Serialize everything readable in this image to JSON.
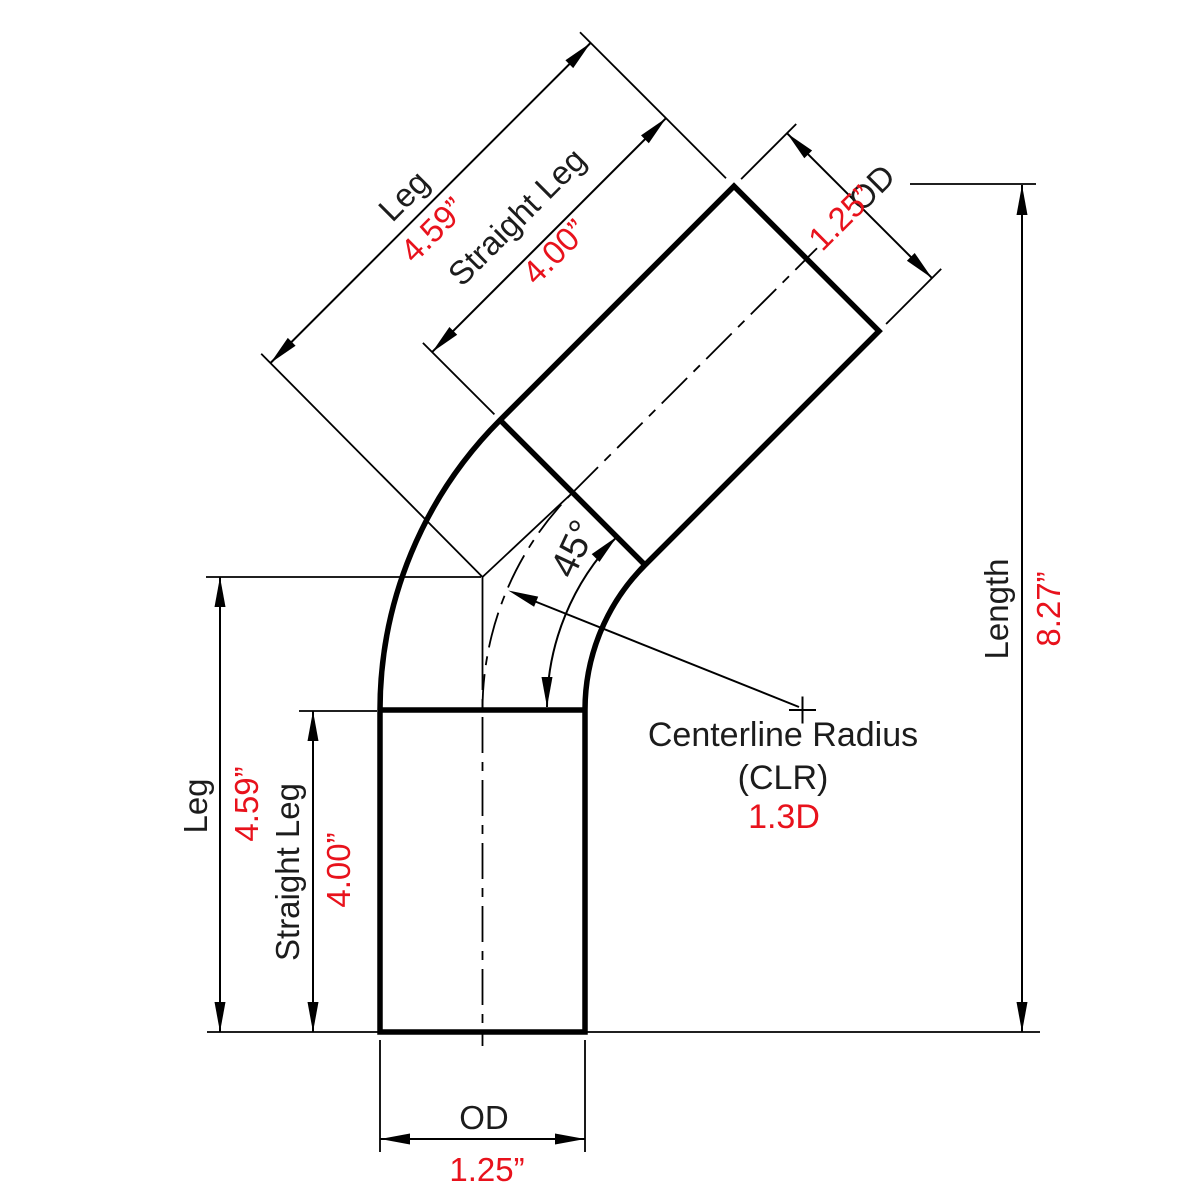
{
  "diagram": {
    "description": "45 degree mandrel tube bend technical drawing",
    "colors": {
      "line": "#000000",
      "label_text": "#1c1c1c",
      "value_text": "#e8121c",
      "background": "#ffffff"
    },
    "dimensions": {
      "leg": {
        "label": "Leg",
        "value": "4.59”"
      },
      "straight_leg": {
        "label": "Straight Leg",
        "value": "4.00”"
      },
      "od": {
        "label": "OD",
        "value": "1.25”"
      },
      "length": {
        "label": "Length",
        "value": "8.27”"
      },
      "bend_angle": {
        "value": "45°"
      },
      "centerline_radius": {
        "label_line1": "Centerline Radius",
        "label_line2": "(CLR)",
        "value": "1.3D"
      }
    }
  }
}
